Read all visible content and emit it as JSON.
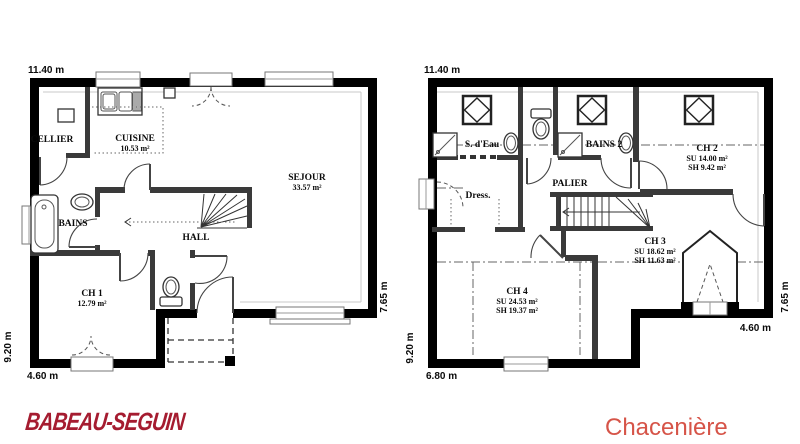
{
  "brand": {
    "logo_text": "BABEAU-SEGUIN",
    "logo_color": "#a51c30",
    "model_name": "Chacenière",
    "model_color": "#d65448"
  },
  "ground_floor": {
    "dim_top": "11.40 m",
    "dim_left": "9.20 m",
    "dim_bottom": "4.60 m",
    "dim_right": "7.65 m",
    "rooms": {
      "cellier": {
        "name": "CELLIER"
      },
      "cuisine": {
        "name": "CUISINE",
        "area": "10.53 m²"
      },
      "sejour": {
        "name": "SEJOUR",
        "area": "33.57 m²"
      },
      "bains": {
        "name": "BAINS"
      },
      "hall": {
        "name": "HALL"
      },
      "ch1": {
        "name": "CH 1",
        "area": "12.79 m²"
      }
    }
  },
  "upper_floor": {
    "dim_top": "11.40 m",
    "dim_left": "9.20 m",
    "dim_bottom_left": "6.80 m",
    "dim_bottom_right": "4.60 m",
    "dim_right": "7.65 m",
    "rooms": {
      "sdeau": {
        "name": "S. d'Eau"
      },
      "bains2": {
        "name": "BAINS 2"
      },
      "palier": {
        "name": "PALIER"
      },
      "dress": {
        "name": "Dress."
      },
      "ch2": {
        "name": "CH 2",
        "su": "SU 14.00 m²",
        "sh": "SH 9.42 m²"
      },
      "ch3": {
        "name": "CH 3",
        "su": "SU 18.62 m²",
        "sh": "SH 11.63 m²"
      },
      "ch4": {
        "name": "CH 4",
        "su": "SU 24.53 m²",
        "sh": "SH 19.37 m²"
      }
    }
  }
}
